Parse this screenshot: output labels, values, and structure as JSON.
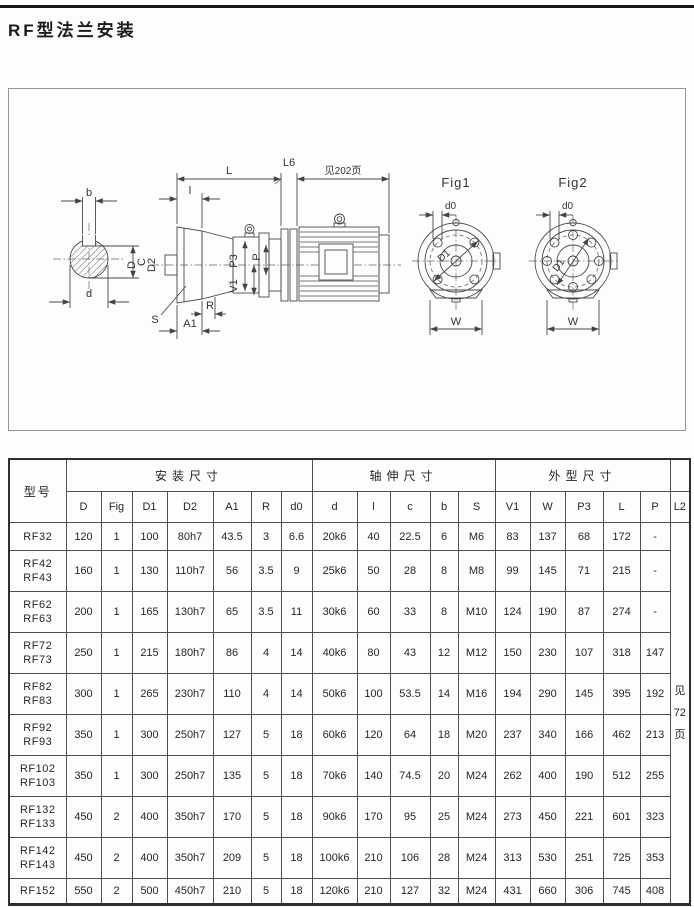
{
  "page": {
    "title": "RF型法兰安装"
  },
  "drawing": {
    "fig1_label": "Fig1",
    "fig2_label": "Fig2",
    "labels": {
      "b": "b",
      "C": "C",
      "d": "d",
      "D": "D",
      "D2": "D2",
      "S": "S",
      "A1": "A1",
      "R": "R",
      "l": "l",
      "L": "L",
      "L6": "L6",
      "see_page": "见202页",
      "P3": "P3",
      "P": "P",
      "V1": "V1",
      "d0": "d0",
      "D1": "D1",
      "W": "W"
    }
  },
  "table": {
    "model_header": "型号",
    "groups": [
      "安装尺寸",
      "轴伸尺寸",
      "外型尺寸"
    ],
    "columns": [
      "D",
      "Fig",
      "D1",
      "D2",
      "A1",
      "R",
      "d0",
      "d",
      "l",
      "c",
      "b",
      "S",
      "V1",
      "W",
      "P3",
      "L",
      "P"
    ],
    "l2_header": "L2",
    "l2_note": [
      "见",
      "72",
      "页"
    ],
    "rows": [
      {
        "models": [
          "RF32"
        ],
        "values": [
          "120",
          "1",
          "100",
          "80h7",
          "43.5",
          "3",
          "6.6",
          "20k6",
          "40",
          "22.5",
          "6",
          "M6",
          "83",
          "137",
          "68",
          "172",
          "-"
        ]
      },
      {
        "models": [
          "RF42",
          "RF43"
        ],
        "values": [
          "160",
          "1",
          "130",
          "110h7",
          "56",
          "3.5",
          "9",
          "25k6",
          "50",
          "28",
          "8",
          "M8",
          "99",
          "145",
          "71",
          "215",
          "-"
        ]
      },
      {
        "models": [
          "RF62",
          "RF63"
        ],
        "values": [
          "200",
          "1",
          "165",
          "130h7",
          "65",
          "3.5",
          "11",
          "30k6",
          "60",
          "33",
          "8",
          "M10",
          "124",
          "190",
          "87",
          "274",
          "-"
        ]
      },
      {
        "models": [
          "RF72",
          "RF73"
        ],
        "values": [
          "250",
          "1",
          "215",
          "180h7",
          "86",
          "4",
          "14",
          "40k6",
          "80",
          "43",
          "12",
          "M12",
          "150",
          "230",
          "107",
          "318",
          "147"
        ]
      },
      {
        "models": [
          "RF82",
          "RF83"
        ],
        "values": [
          "300",
          "1",
          "265",
          "230h7",
          "110",
          "4",
          "14",
          "50k6",
          "100",
          "53.5",
          "14",
          "M16",
          "194",
          "290",
          "145",
          "395",
          "192"
        ]
      },
      {
        "models": [
          "RF92",
          "RF93"
        ],
        "values": [
          "350",
          "1",
          "300",
          "250h7",
          "127",
          "5",
          "18",
          "60k6",
          "120",
          "64",
          "18",
          "M20",
          "237",
          "340",
          "166",
          "462",
          "213"
        ]
      },
      {
        "models": [
          "RF102",
          "RF103"
        ],
        "values": [
          "350",
          "1",
          "300",
          "250h7",
          "135",
          "5",
          "18",
          "70k6",
          "140",
          "74.5",
          "20",
          "M24",
          "262",
          "400",
          "190",
          "512",
          "255"
        ]
      },
      {
        "models": [
          "RF132",
          "RF133"
        ],
        "values": [
          "450",
          "2",
          "400",
          "350h7",
          "170",
          "5",
          "18",
          "90k6",
          "170",
          "95",
          "25",
          "M24",
          "273",
          "450",
          "221",
          "601",
          "323"
        ]
      },
      {
        "models": [
          "RF142",
          "RF143"
        ],
        "values": [
          "450",
          "2",
          "400",
          "350h7",
          "209",
          "5",
          "18",
          "100k6",
          "210",
          "106",
          "28",
          "M24",
          "313",
          "530",
          "251",
          "725",
          "353"
        ]
      },
      {
        "models": [
          "RF152"
        ],
        "values": [
          "550",
          "2",
          "500",
          "450h7",
          "210",
          "5",
          "18",
          "120k6",
          "210",
          "127",
          "32",
          "M24",
          "431",
          "660",
          "306",
          "745",
          "408"
        ]
      }
    ]
  }
}
